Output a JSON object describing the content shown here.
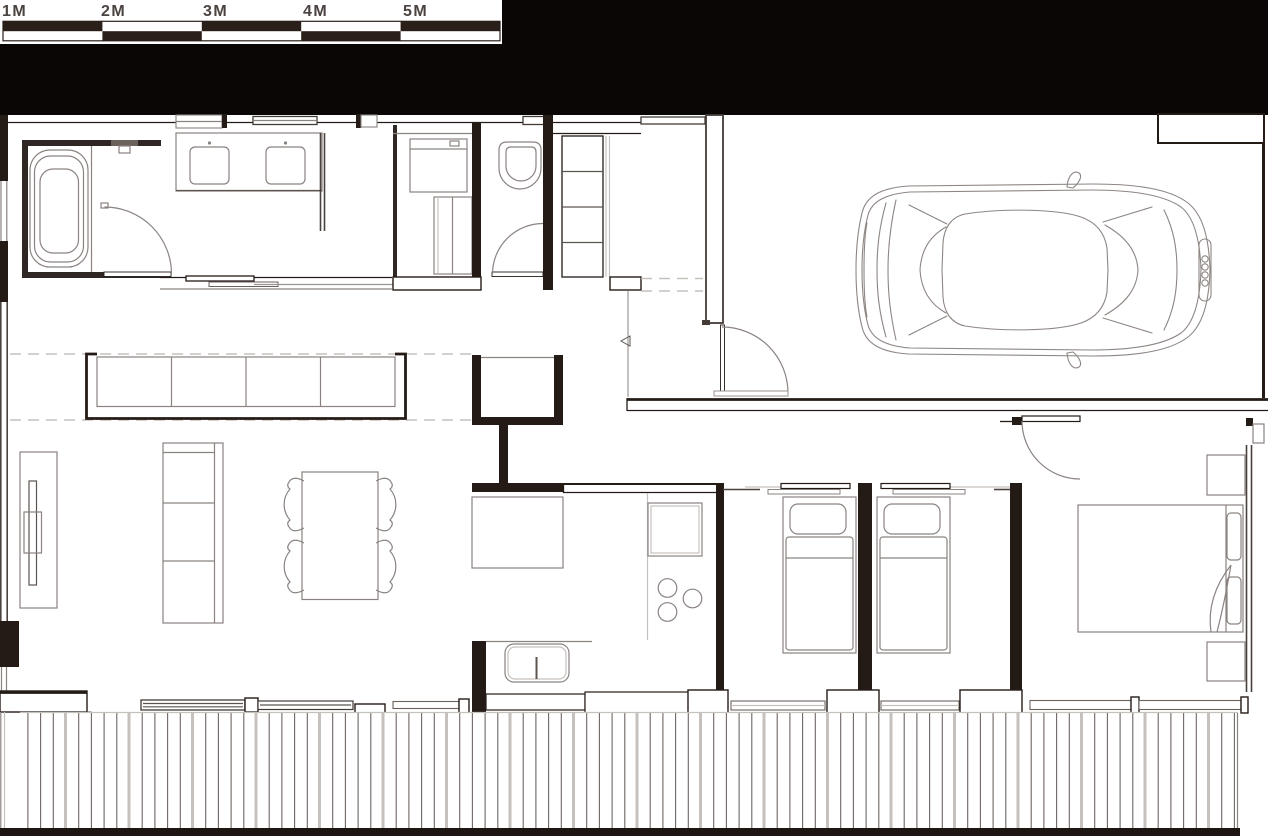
{
  "scale_bar": {
    "labels": [
      "1M",
      "2M",
      "3M",
      "4M",
      "5M"
    ],
    "unit": "M",
    "segment_count": 5,
    "bar_fill_color": "#2b1f1a",
    "label_color": "#4a4340",
    "background": "#ffffff"
  },
  "canvas": {
    "header_color": "#0a0605",
    "background": "#ffffff",
    "wall_color": "#241b16",
    "furniture_line_color": "#8a8380",
    "light_line_color": "#c6c1bd",
    "deck_bottom_band_color": "#1c1512"
  },
  "icons": [
    "bathtub-icon",
    "shower-icon",
    "vanity-sink-icon",
    "washing-machine-icon",
    "toilet-icon",
    "closet-shelves-icon",
    "entry-arrow-icon",
    "door-swing-icon",
    "car-icon",
    "audi-rings-icon",
    "window-seat-icon",
    "tv-console-icon",
    "sofa-icon",
    "dining-table-icon",
    "chair-icon",
    "pantry-icon",
    "fridge-icon",
    "oven-icon",
    "cooktop-burner-icon",
    "kitchen-sink-icon",
    "bed-single-icon",
    "bed-double-icon",
    "pillow-icon",
    "nightstand-icon",
    "sliding-door-icon",
    "deck-planks-icon"
  ]
}
